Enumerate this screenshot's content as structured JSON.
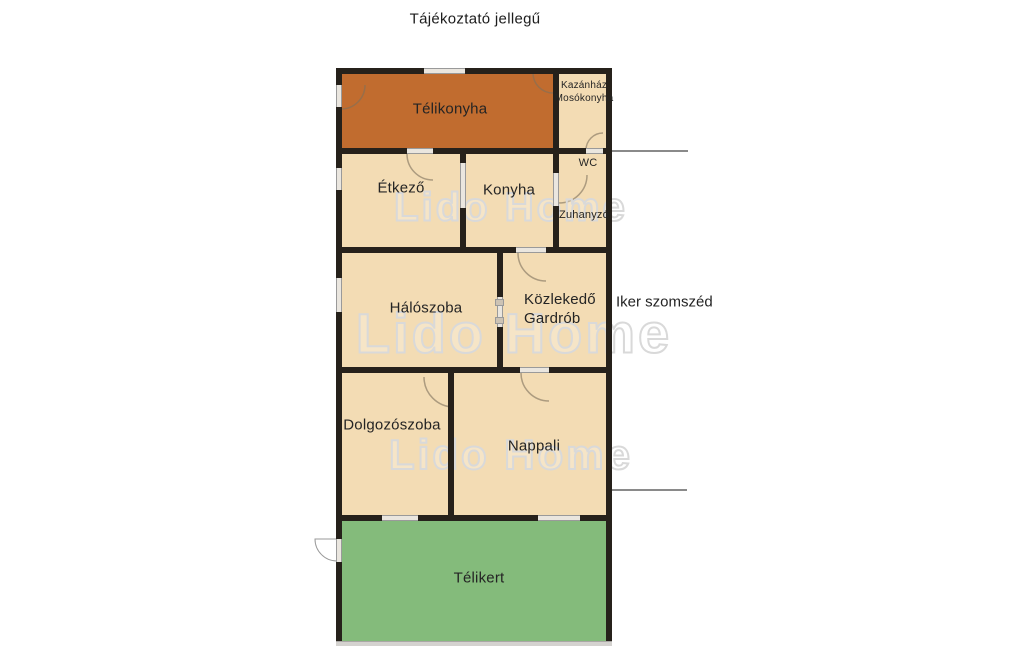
{
  "title": "Tájékoztató jellegű",
  "watermark": {
    "text": "Lido Home"
  },
  "neighbor_label": "Iker szomszéd",
  "colors": {
    "room_fill": "#f3dcb4",
    "winter_kitchen_fill": "#c16c2f",
    "winter_garden_fill": "#84bb7b",
    "wall": "#26211b",
    "opening": "#eae6df",
    "divider_line": "#8a8a8a",
    "watermark": "#d9d9d9"
  },
  "rooms": {
    "telikonyha": {
      "label": "Télikonyha"
    },
    "kazanhaz": {
      "line1": "Kazánház",
      "line2": "Mosókonyha"
    },
    "etkezo": {
      "label": "Étkező"
    },
    "konyha": {
      "label": "Konyha"
    },
    "wc": {
      "label": "WC"
    },
    "zuhanyzo": {
      "label": "Zuhanyzó"
    },
    "haloszoba": {
      "label": "Hálószoba"
    },
    "kozlekedo": {
      "line1": "Közlekedő",
      "line2": "Gardrób"
    },
    "dolgozoszoba": {
      "label": "Dolgozószoba"
    },
    "nappali": {
      "label": "Nappali"
    },
    "telikert": {
      "label": "Télikert"
    }
  }
}
